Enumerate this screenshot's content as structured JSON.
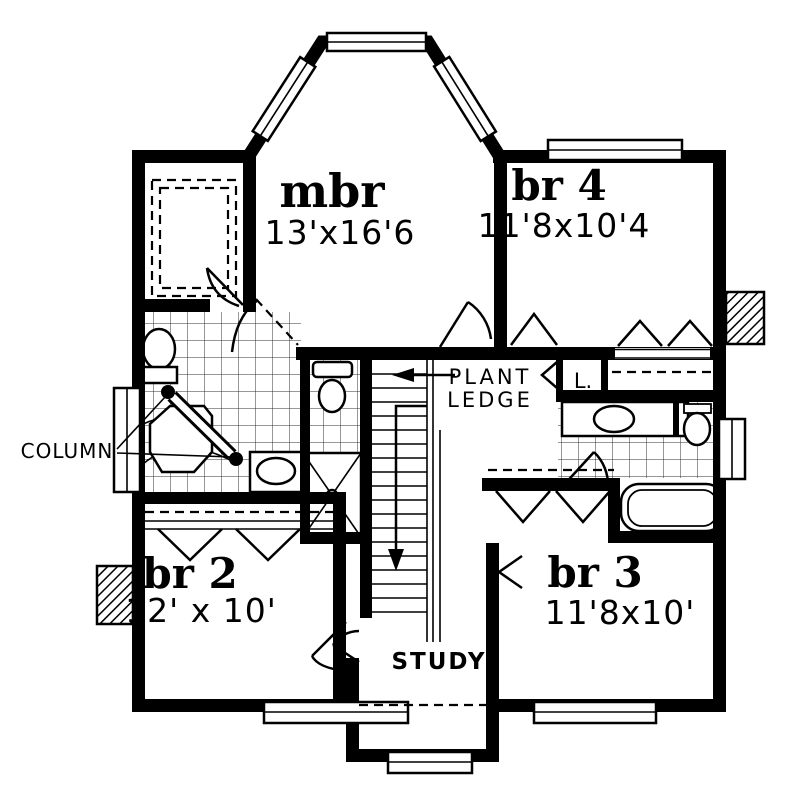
{
  "plan": {
    "type": "floor-plan",
    "rooms": {
      "mbr": {
        "name": "mbr",
        "dims": "13'x16'6"
      },
      "br4": {
        "name": "br 4",
        "dims": "11'8x10'4"
      },
      "br2": {
        "name": "br 2",
        "dims": "12' x 10'"
      },
      "br3": {
        "name": "br 3",
        "dims": "11'8x10'"
      },
      "study": {
        "name": "STUDY"
      }
    },
    "annotations": {
      "plant_ledge_line1": "PLANT",
      "plant_ledge_line2": "LEDGE",
      "column": "COLUMN",
      "linen_closet": "L."
    },
    "colors": {
      "ink": "#000000",
      "paper": "#ffffff"
    }
  }
}
